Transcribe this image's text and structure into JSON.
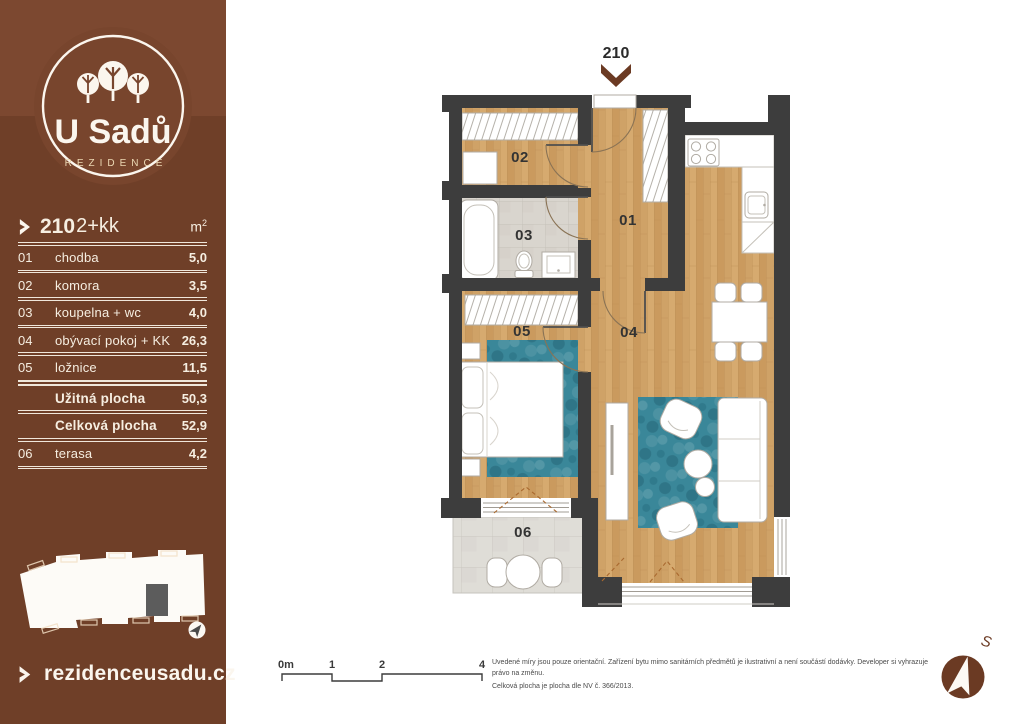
{
  "sidebar": {
    "logo": {
      "name": "U Sadů",
      "tagline": "REZIDENCE"
    },
    "unit_header": {
      "number": "210",
      "layout": "2+kk",
      "unit": "m",
      "unit_exp": "2"
    },
    "rooms": [
      {
        "id": "01",
        "name": "chodba",
        "area": "5,0"
      },
      {
        "id": "02",
        "name": "komora",
        "area": "3,5"
      },
      {
        "id": "03",
        "name": "koupelna + wc",
        "area": "4,0"
      },
      {
        "id": "04",
        "name": "obývací pokoj + KK",
        "area": "26,3"
      },
      {
        "id": "05",
        "name": "ložnice",
        "area": "11,5"
      }
    ],
    "totals": [
      {
        "label": "Užitná plocha",
        "value": "50,3"
      },
      {
        "label": "Celková plocha",
        "value": "52,9"
      }
    ],
    "outdoor": {
      "id": "06",
      "name": "terasa",
      "area": "4,2"
    },
    "website": {
      "url": "rezidenceusadu.cz"
    }
  },
  "plan": {
    "entrance_label": "210",
    "labels": {
      "r01": "01",
      "r02": "02",
      "r03": "03",
      "r04": "04",
      "r05": "05",
      "r06": "06"
    }
  },
  "scale_bar": {
    "labels": [
      "0m",
      "1",
      "2",
      "4"
    ]
  },
  "disclaimer": {
    "line1": "Uvedené míry jsou pouze orientační. Zařízení bytu mimo sanitárních předmětů je ilustrativní a není součástí dodávky. Developer si vyhrazuje právo na změnu.",
    "line2": "Celková plocha je plocha dle NV č. 366/2013."
  },
  "compass": {
    "north": "S"
  },
  "icons": [
    "chevron-right-icon",
    "entrance-arrow-icon",
    "compass-icon",
    "trees-logo-icon"
  ],
  "colors": {
    "sidebar": "#6f3f28",
    "sidebar_top": "#7c4830",
    "accent_brown": "#6b3a23",
    "wall": "#3d3d3d",
    "wood": "#d0a368",
    "rug_teal": "#3a8799",
    "cream_text": "#f6eee1",
    "tagline_gold": "#ecd9b4"
  }
}
